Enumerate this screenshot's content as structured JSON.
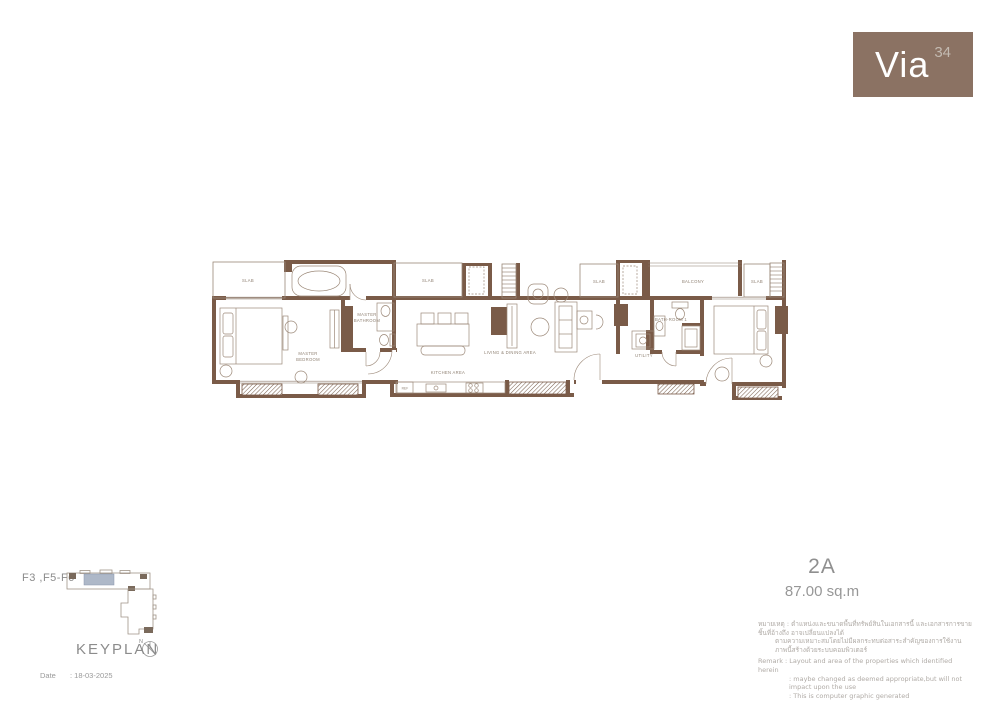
{
  "brand": {
    "name": "Via",
    "number": "34"
  },
  "unit": {
    "name": "2A",
    "area": "87.00 sq.m"
  },
  "plan_labels": {
    "slab": "SLAB",
    "balcony": "BALCONY",
    "master_bathroom_line1": "MASTER",
    "master_bathroom_line2": "BATHROOM",
    "master_bedroom_line1": "MASTER",
    "master_bedroom_line2": "BEDROOM",
    "living_dining": "LIVING & DINING AREA",
    "kitchen": "KITCHEN AREA",
    "ref": "REF",
    "bathroom1": "BATH-ROOM 1",
    "utility": "UTILITY"
  },
  "keyplan": {
    "floors": "F3 ,F5-F6",
    "title": "KEYPLAN",
    "compass_n": "N"
  },
  "footer": {
    "date_label": "Date",
    "date_value": ": 18-03-2025"
  },
  "disclaimer": {
    "thai_line1": "หมายเหตุ : ตำแหน่งและขนาดพื้นที่ทรัพย์สินในเอกสารนี้ และเอกสารการขายชิ้นที่อ้างถึง อาจเปลี่ยนแปลงได้",
    "thai_line2": "ตามความเหมาะสมโดยไม่มีผลกระทบต่อสาระสำคัญของการใช้งาน",
    "thai_line3": "ภาพนี้สร้างด้วยระบบคอมพิวเตอร์",
    "remark_label": "Remark",
    "remark_line1": ": Layout and area of the properties which identified herein",
    "remark_line2": ": maybe changed as deemed appropriate,but will not impact upon the use",
    "remark_line3": ": This is computer graphic generated"
  },
  "colors": {
    "wall_brown": "#7a5b48",
    "logo_background": "#8b7263",
    "keyplan_highlight": "#aeb8c8",
    "label_gray": "#8f8173"
  }
}
